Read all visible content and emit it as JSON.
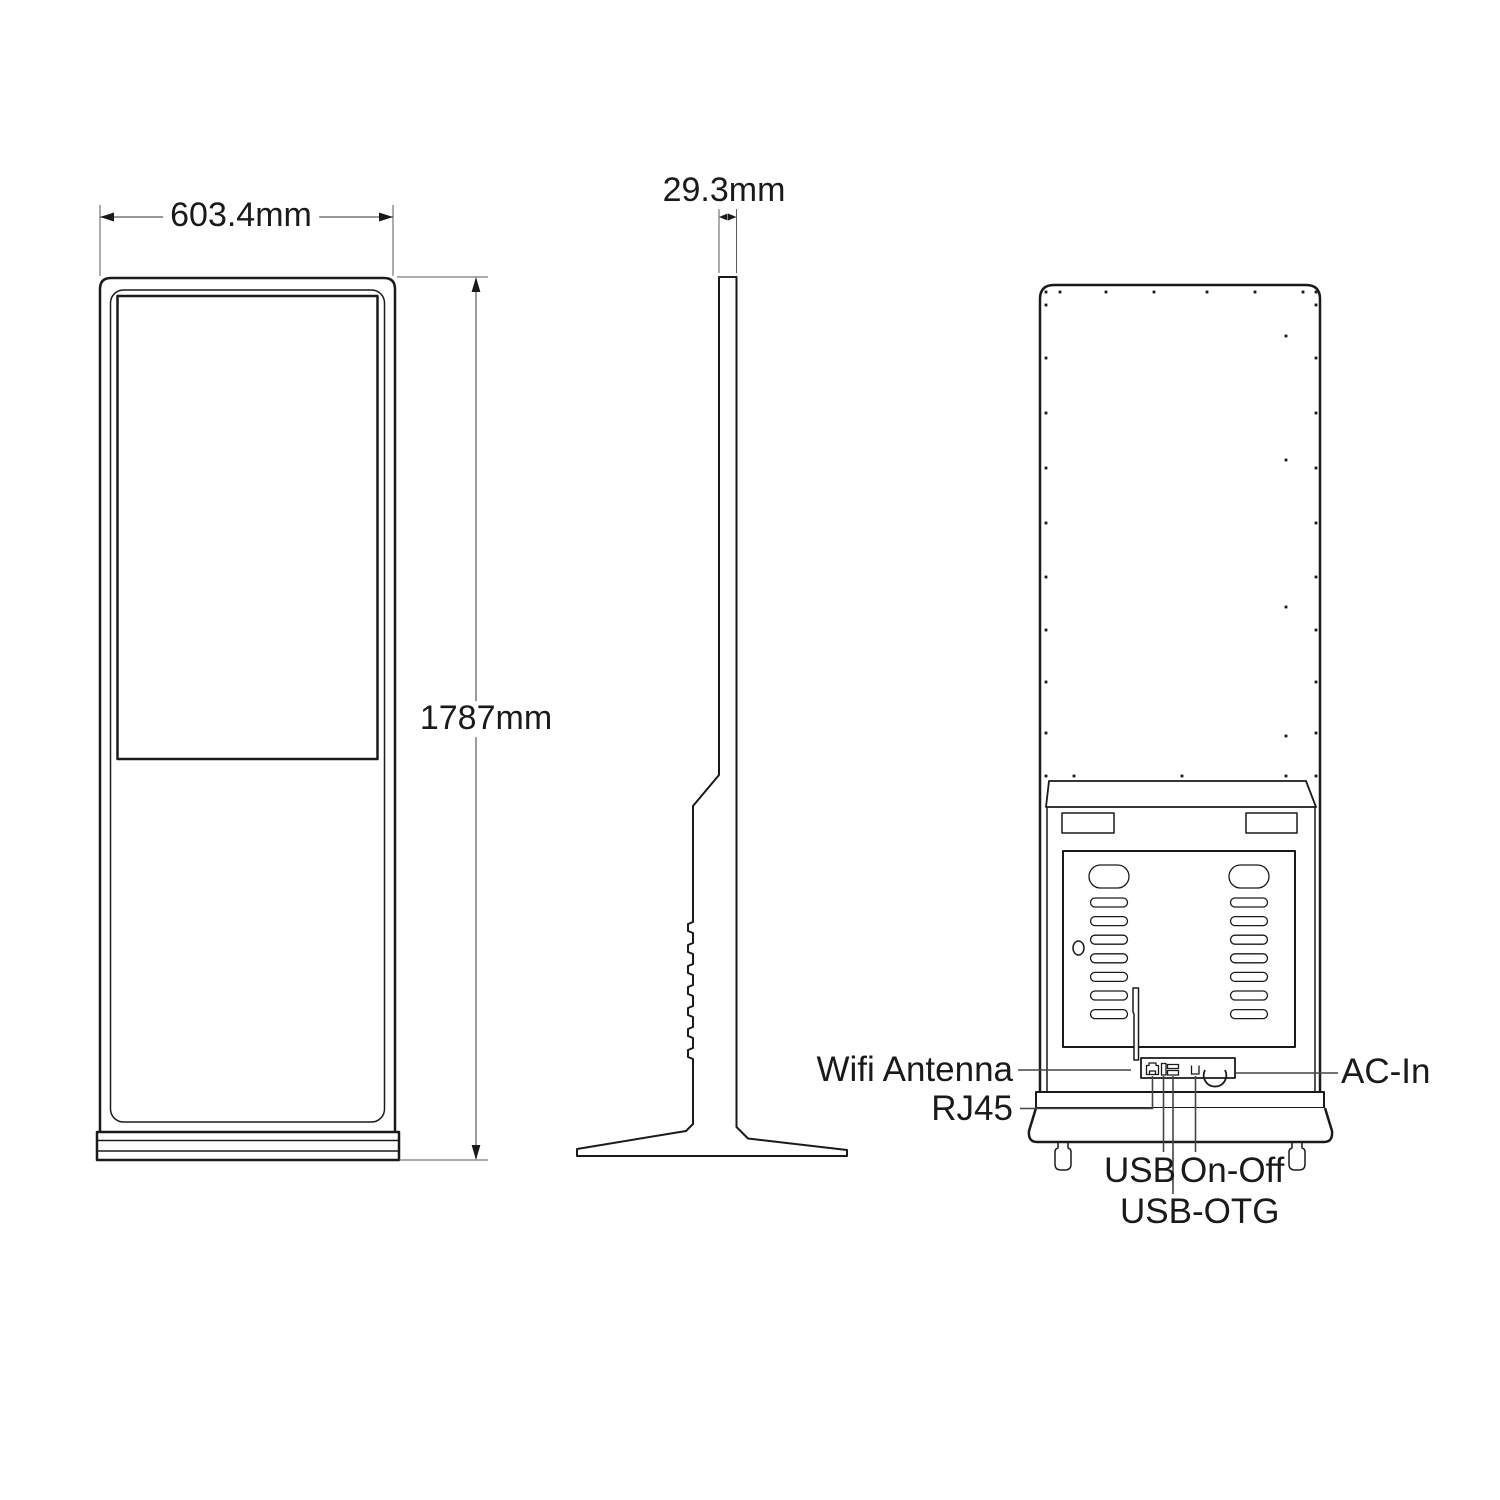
{
  "drawing": {
    "dimensions": {
      "front_width": "603.4mm",
      "front_height": "1787mm",
      "side_depth": "29.3mm"
    },
    "callouts": {
      "wifi_antenna": "Wifi Antenna",
      "rj45": "RJ45",
      "usb": "USB",
      "usb_otg": "USB-OTG",
      "on_off": "On-Off",
      "ac_in": "AC-In"
    },
    "colors": {
      "line": "#1a1a1a",
      "leader": "#454545",
      "dim": "#5a5a5a",
      "background": "#ffffff"
    },
    "rear_screws": {
      "top_row_y": 292,
      "top_row_x": [
        1046,
        1060,
        1106,
        1154,
        1207,
        1255,
        1303,
        1316
      ],
      "left_col_x": 1046,
      "right_col_x": 1316,
      "col_y": [
        305,
        358,
        413,
        468,
        523,
        577,
        630,
        682,
        733,
        776
      ],
      "bottom_row_y": 776,
      "bottom_row_x": [
        1074,
        1182,
        1286
      ],
      "inner_col_x": 1286,
      "inner_col_y": [
        336,
        460,
        607,
        736
      ]
    },
    "rear_vents": {
      "columns_x": [
        1089,
        1229
      ],
      "big_slot": {
        "y": 865,
        "w": 40,
        "h": 23
      },
      "small_slots": {
        "w": 37,
        "h": 9,
        "first_y": 898,
        "pitch": 18.6,
        "count": 7
      }
    },
    "side_notches": {
      "start_y": 922,
      "pitch": 21,
      "count": 7,
      "depth": 5,
      "height": 11
    }
  }
}
